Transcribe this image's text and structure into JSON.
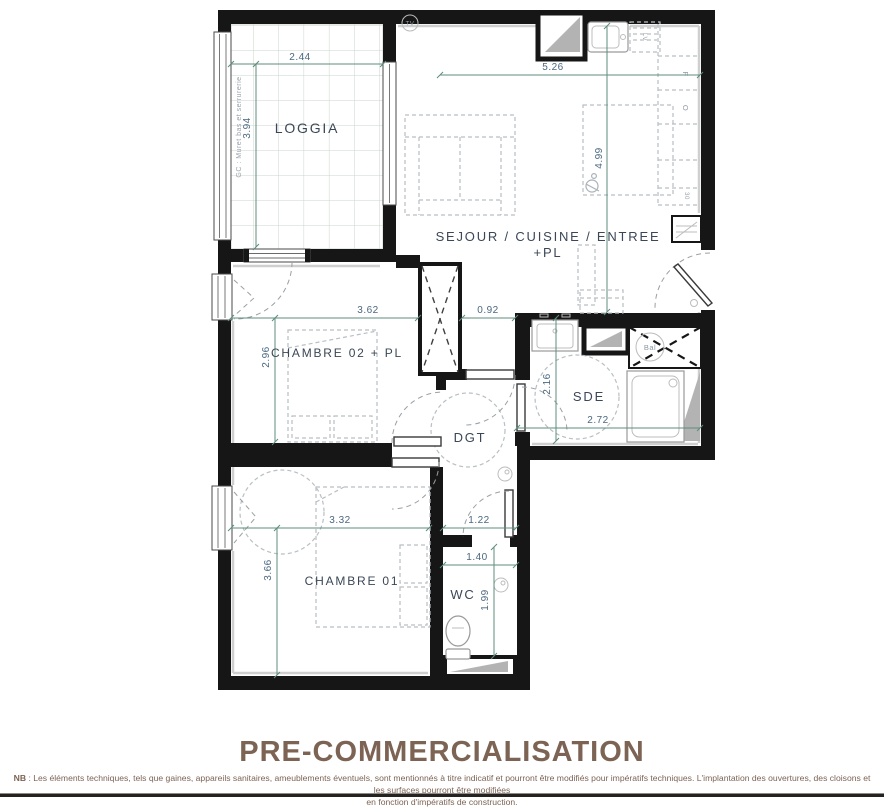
{
  "plan": {
    "rooms": {
      "loggia": "LOGGIA",
      "sejour_line1": "SEJOUR / CUISINE / ENTREE",
      "sejour_line2": "+PL",
      "chambre02": "CHAMBRE 02 + PL",
      "sde": "SDE",
      "dgt": "DGT",
      "chambre01": "CHAMBRE 01",
      "wc": "WC"
    },
    "dimensions": {
      "loggia_width": "2.44",
      "loggia_depth": "3.94",
      "sejour_width": "5.26",
      "sejour_depth": "4.99",
      "chambre02_width": "3.62",
      "entree_passage": "0.92",
      "chambre02_depth": "2.96",
      "sde_depth": "2.16",
      "sde_width": "2.72",
      "chambre01_width": "3.32",
      "dgt_width": "1.22",
      "chambre01_depth": "3.66",
      "wc_width": "1.40",
      "wc_depth": "1.99"
    },
    "annotations": {
      "gc_note": "GC : Muret bas et serrurerie",
      "tv": "TV",
      "fridge": "F",
      "oven": "O",
      "dishwasher": "LV",
      "ballon": "Bal",
      "niche_depth": "30"
    },
    "colors": {
      "wall": "#161616",
      "dimension_line": "#5d8d7c",
      "dimension_text": "#4a6880",
      "room_label": "#3b4756",
      "brand_brown": "#7c6354",
      "shaft_gray": "#b3b3b3"
    }
  },
  "footer": {
    "title": "PRE-COMMERCIALISATION",
    "note_bold": "NB",
    "note_line1": " : Les éléments techniques, tels que gaines, appareils sanitaires, ameublements éventuels, sont mentionnés à titre indicatif et pourront être modifiés pour impératifs techniques. L'implantation des ouvertures, des cloisons et les surfaces pourront être modifiées",
    "note_line2": "en fonction d'impératifs de construction."
  }
}
